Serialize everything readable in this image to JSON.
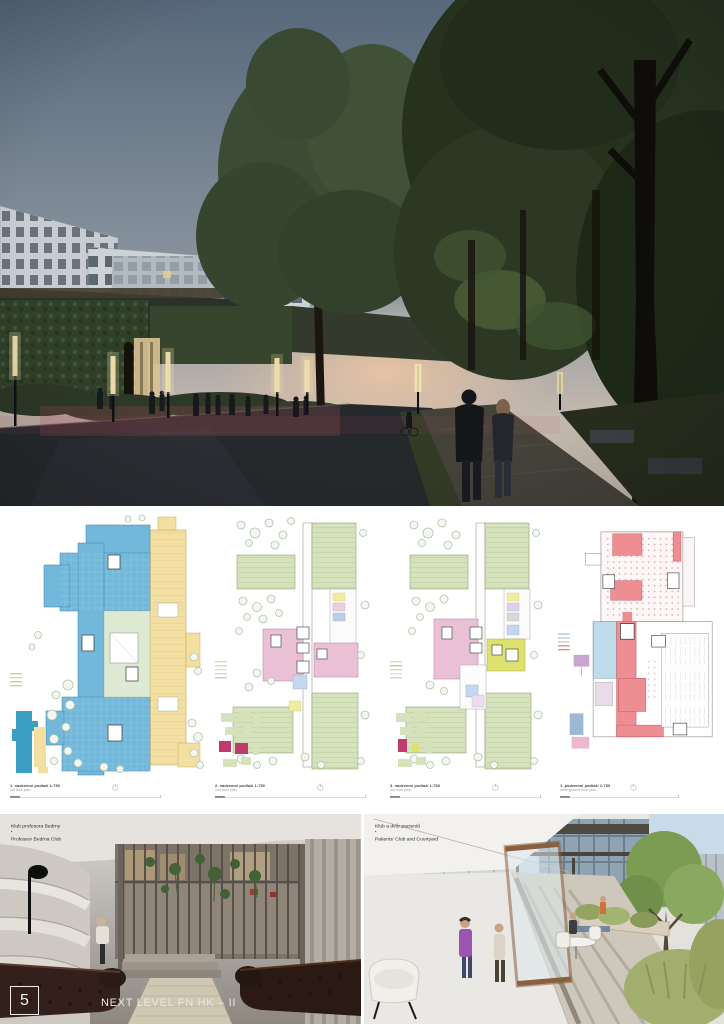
{
  "palette": {
    "plan_blue": "#72b8da",
    "plan_blue_deep": "#3d9ec4",
    "plan_yellow": "#f3dfa2",
    "plan_green": "#d5e2bb",
    "plan_pink": "#eac1d4",
    "plan_red": "#ee8e92",
    "plan_light_blue": "#bedcec",
    "plan_lime": "#dde26e",
    "plan_magenta": "#c2396e",
    "plan_purple": "#c9a6d0",
    "plan_courtyard": "#dde9d2",
    "tree_outline": "#b2c5a9",
    "sky_top": "#57687a",
    "sky_horizon": "#c3b8ad",
    "sunset_glow": "#dca18b",
    "foliage": "#3c4b33",
    "forest_dark": "#28331f",
    "road": "#26292b",
    "red_glow": "#b4525e"
  },
  "plans": {
    "items": [
      {
        "label_cz": "1. nadzemní podlaží 1:750",
        "label_en": "1st floor plan"
      },
      {
        "label_cz": "2. nadzemní podlaží 1:750",
        "label_en": "2nd floor plan"
      },
      {
        "label_cz": "3. nadzemní podlaží 1:750",
        "label_en": "3rd floor plan"
      },
      {
        "label_cz": "1. podzemní podlaží 1:750",
        "label_en": "underground floor plan"
      }
    ]
  },
  "bottom": {
    "left_render": {
      "label_cz": "Klub profesora Bedrny",
      "separator": "•",
      "label_en": "Professor Bedrna Club"
    },
    "right_render": {
      "label_cz": "Klub a dvůr pacientů",
      "separator": "•",
      "label_en": "Patients' Club and Courtyard"
    }
  },
  "footer": {
    "page_number": "5",
    "title": "NEXT LEVEL FN HK – II"
  }
}
